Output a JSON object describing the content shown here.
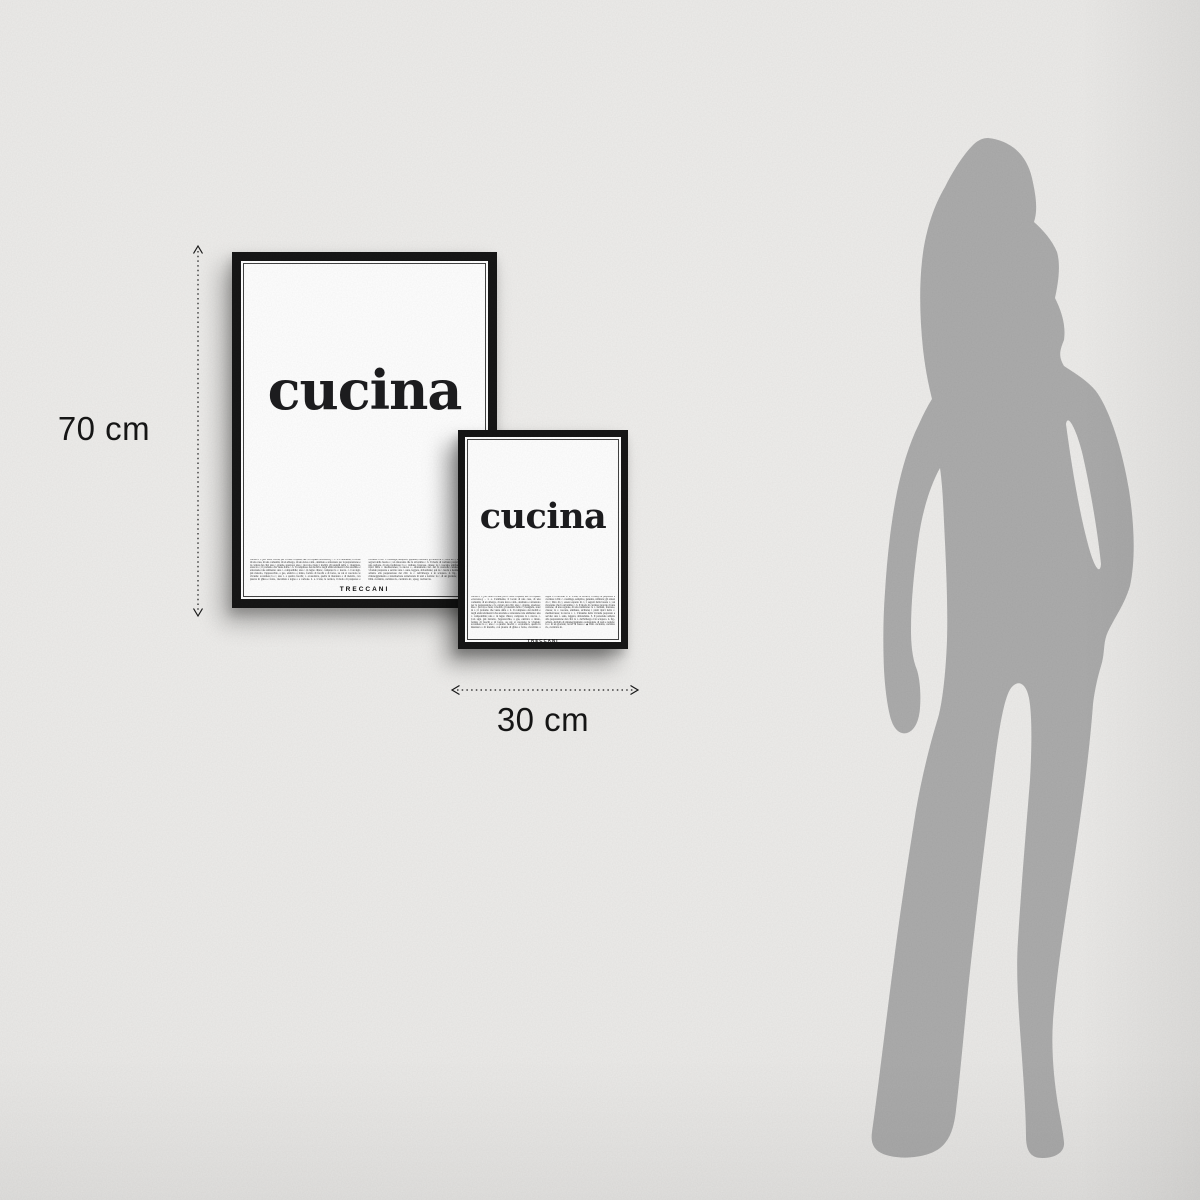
{
  "scene": {
    "description": "Two framed dictionary-definition posters on a wall with size arrows and a human silhouette for scale",
    "wall_color": "#ecebe9",
    "frame_color": "#161616",
    "silhouette_color": "#acacac"
  },
  "posters": {
    "large": {
      "word": "cucina",
      "brand": "TRECCANI",
      "definition": "cucina s. f. [lat. tardo cocīna, per il class. coquīna, der. di coquĕre «cuocere»]. – 1. a. L'ambiente, il locale di una casa, di una comunità, di un albergo, di una nave e sim., destinato e attrezzato per la preparazione e la cottura dei cibi: una c. grande, spaziosa; una c. piccola e buia; i mobili, gli utensili della c.; mangiare, stare in c.; il profumo che viene dalla c. b. Il complesso dei mobili e degli elettrodomestici che arredano e attrezzano tale ambiente: una c. componibile; una c. in legno chiaro; comprare la c. nuova. c. Con sign. più ristretto, l'apparecchio, a gas, elettrico o misto, fornito di fuochi e di forno, su cui si cuociono le vivande: accendere la c.; una c. a quattro fuochi; c. economica, quella in muratura o di metallo, con piastra di ghisa e forno, riscaldata a legna o a carbone. 2. a. L'arte, la tecnica, il modo di preparare e cucinare i cibi: c. casalinga, semplice, genuina, raffinata; gli arnesi di c.; libro di c.; essere esperto di c.; i segreti della buona c.; un ristorante che fa un'ottima c. b. Il modo di cucinare proprio di una nazione, di una regione, di una tradizione: la c. italiana, francese, cinese; la c. toscana, emiliana, siciliana; i piatti tipici della c. mediterranea; la nuova c., adattamento ital. del fr. nouvelle cuisine. c. L'insieme delle vivande preparate e servite: una c. sana, leggera, abbondante; qui la c. lascia a desiderare. 3. Il personale addetto alla preparazione dei cibi: la c. dell'albergo è in sciopero. 4. fig., scherz. Attività di rimaneggiamento e sistemazione redazionale di testi e notizie: la c. di un giornale; lavori di bassa c. ◆ Dim. cucinétta, cucinino m., cucinòtto m.; spreg. cucinàccia."
    },
    "small": {
      "word": "cucina",
      "brand": "TRECCANI",
      "definition": "cucina s. f. [lat. tardo cocīna, per il class. coquīna, der. di coquĕre «cuocere»]. – 1. a. L'ambiente, il locale di una casa, di una comunità, di un albergo, di una nave e sim., destinato e attrezzato per la preparazione e la cottura dei cibi: una c. grande, spaziosa; una c. piccola e buia; i mobili, gli utensili della c.; mangiare, stare in c.; il profumo che viene dalla c. b. Il complesso dei mobili e degli elettrodomestici che arredano e attrezzano tale ambiente: una c. componibile; una c. in legno chiaro; comprare la c. nuova. c. Con sign. più ristretto, l'apparecchio, a gas, elettrico o misto, fornito di fuochi e di forno, su cui si cuociono le vivande: accendere la c.; una c. a quattro fuochi; c. economica, quella in muratura o di metallo, con piastra di ghisa e forno, riscaldata a legna o a carbone. 2. a. L'arte, la tecnica, il modo di preparare e cucinare i cibi: c. casalinga, semplice, genuina, raffinata; gli arnesi di c.; libro di c.; essere esperto di c.; i segreti della buona c.; un ristorante che fa un'ottima c. b. Il modo di cucinare proprio di una nazione, di una regione, di una tradizione: la c. italiana, francese, cinese; la c. toscana, emiliana, siciliana; i piatti tipici della c. mediterranea; la nuova c. c. L'insieme delle vivande preparate e servite: una c. sana, leggera, abbondante. 3. Il personale addetto alla preparazione dei cibi: la c. dell'albergo è in sciopero. 4. fig., scherz. Attività di rimaneggiamento redazionale di testi e notizie: la c. di un giornale; lavori di bassa c. ◆ Dim. cucinétta, cucinino m., cucinòtto m."
    }
  },
  "dimensions": {
    "height_label": "70 cm",
    "width_label": "30 cm"
  }
}
